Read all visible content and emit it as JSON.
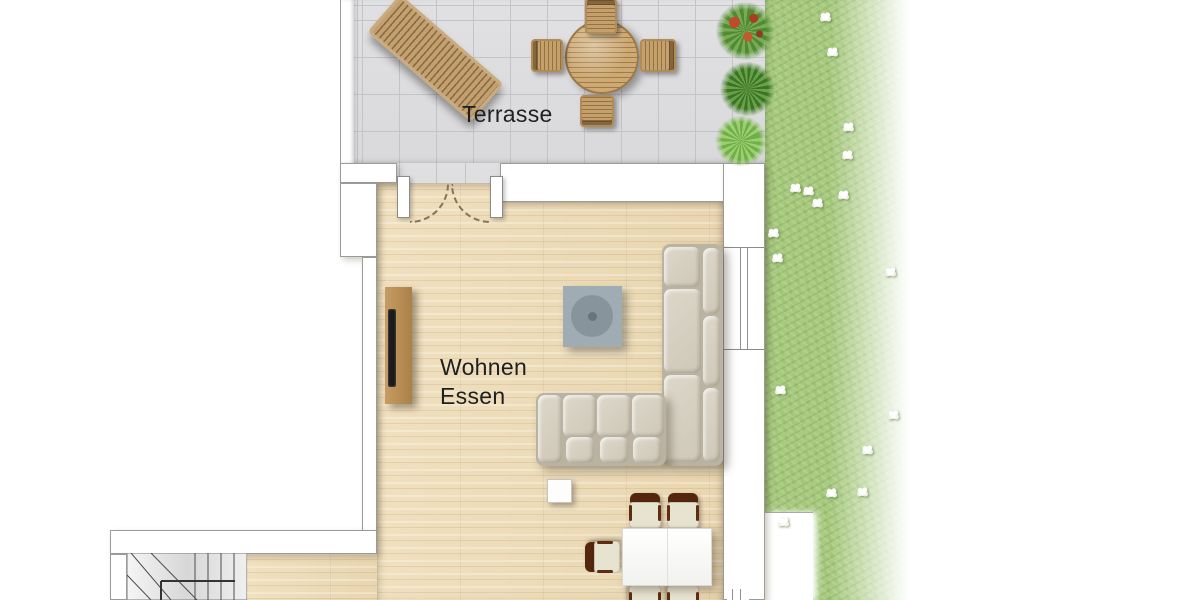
{
  "plan": {
    "labels": {
      "terrace": "Terrasse",
      "living": "Wohnen",
      "dining": "Essen"
    },
    "colors": {
      "tile": "#dfdfe1",
      "grout": "#c3c3c8",
      "wood": "#eedcba",
      "lawn": "#a9cb80",
      "wall-line": "#9b9b9b",
      "sofa": "#d6d0c2",
      "stove": "#a0acb3",
      "sideboard": "#bb9059",
      "chair-brown": "#54260d",
      "label-text": "#1f1f1f"
    },
    "furniture": [
      "sun-lounger",
      "terrace-round-table",
      "terrace-chairs",
      "planter-shrubs",
      "lawn-daisies",
      "tv-sideboard",
      "tv",
      "stove",
      "corner-sofa",
      "side-table",
      "dining-table",
      "dining-chairs",
      "winder-stairs",
      "double-door",
      "window"
    ]
  }
}
